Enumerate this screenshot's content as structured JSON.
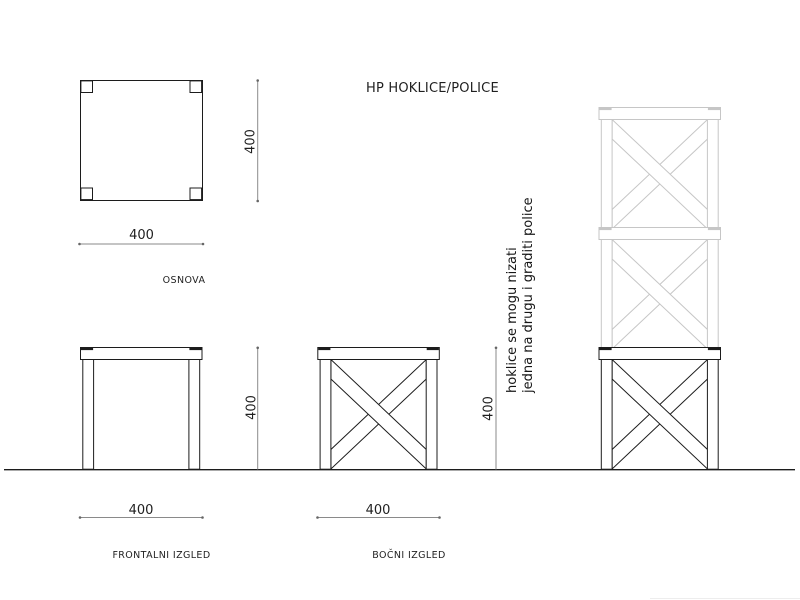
{
  "title": "HP HOKLICE/POLICE",
  "views": {
    "plan": {
      "label": "OSNOVA",
      "width_dim": "400",
      "height_dim": "400"
    },
    "front": {
      "label": "FRONTALNI IZGLED",
      "width_dim": "400",
      "height_dim": "400"
    },
    "side": {
      "label": "BOČNI IZGLED",
      "width_dim": "400",
      "height_dim": "400"
    }
  },
  "note": {
    "line1": "hoklice se mogu nizati",
    "line2": "jedna na drugu i graditi police"
  },
  "colors": {
    "ink": "#1c1c1c",
    "ghost": "#c6c6c6",
    "dim_line": "#8a8a8a"
  }
}
